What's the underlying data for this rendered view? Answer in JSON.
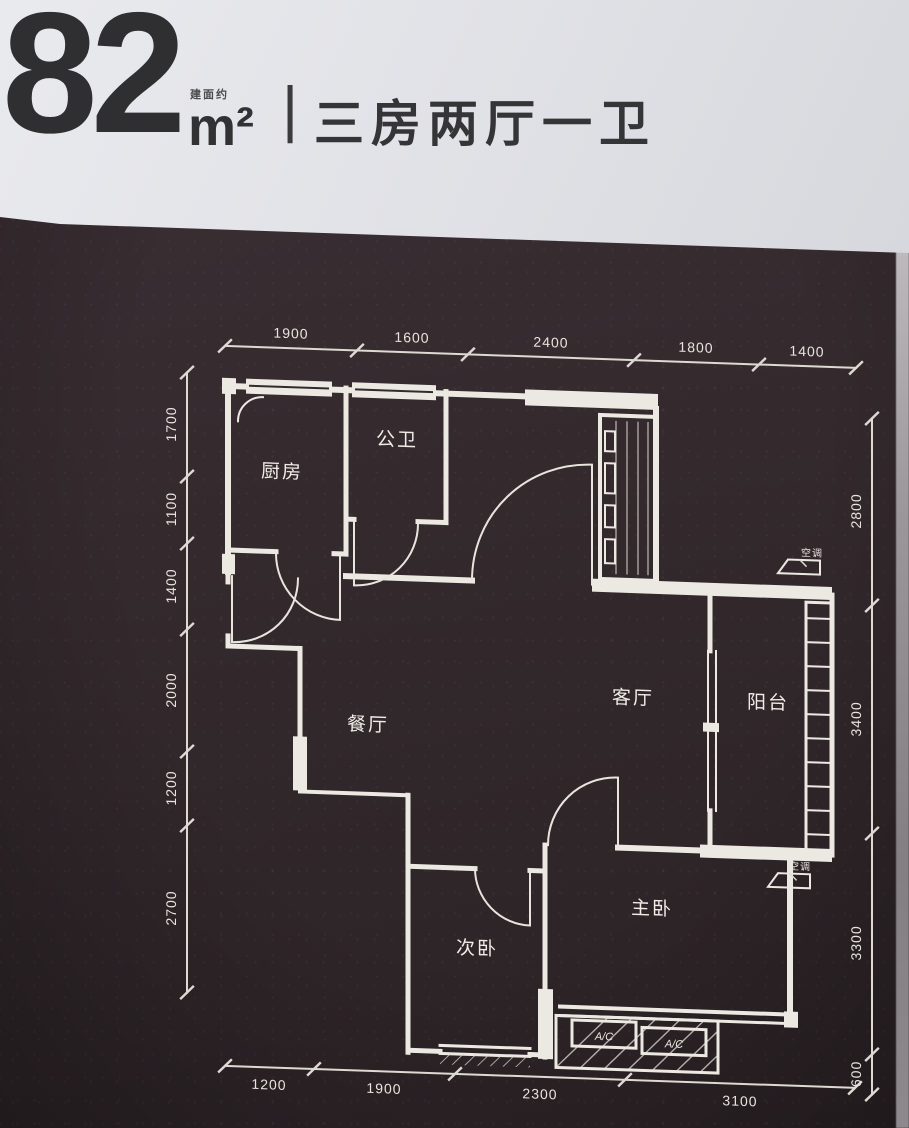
{
  "header": {
    "area_note": "建面约",
    "area_value": "82",
    "area_unit": "m²",
    "divider": "|",
    "layout_text": "三房两厅一卫"
  },
  "plan": {
    "rooms": [
      {
        "label": "厨房"
      },
      {
        "label": "公卫"
      },
      {
        "label": "餐厅"
      },
      {
        "label": "客厅"
      },
      {
        "label": "阳台"
      },
      {
        "label": "次卧"
      },
      {
        "label": "主卧"
      }
    ],
    "annotations": {
      "ac_unit": "A/C",
      "ac_outdoor": "空调"
    },
    "dimensions": {
      "top": [
        "1900",
        "1600",
        "2400",
        "1800",
        "1400"
      ],
      "left": [
        "1700",
        "1100",
        "1400",
        "2000",
        "1200",
        "2700"
      ],
      "right": [
        "2800",
        "3400",
        "3300",
        "600"
      ],
      "bottom": [
        "1200",
        "1900",
        "2300",
        "3100"
      ]
    }
  },
  "colors": {
    "board": "#342a2e",
    "line": "#ece9e3",
    "header_bg": "#e2e3e7",
    "header_text": "#333335"
  }
}
